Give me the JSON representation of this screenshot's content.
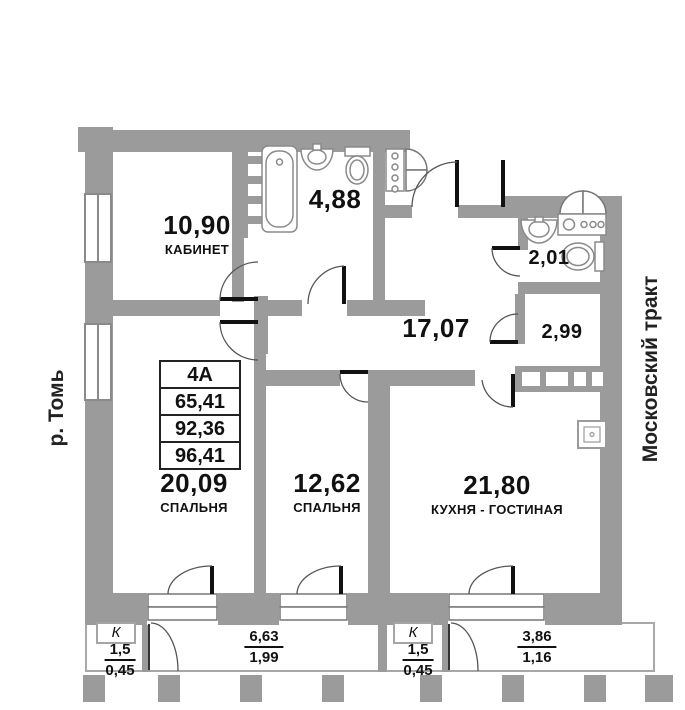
{
  "plan": {
    "title": "apartment-floor-plan",
    "streets": {
      "left": "р. Томь",
      "right": "Московский тракт"
    },
    "unit_table": {
      "unit": "4А",
      "rows": [
        "65,41",
        "92,36",
        "96,41"
      ]
    },
    "rooms": [
      {
        "id": "office",
        "area": "10,90",
        "name": "КАБИНЕТ"
      },
      {
        "id": "bathroom",
        "area": "4,88",
        "name": ""
      },
      {
        "id": "toilet",
        "area": "2,01",
        "name": ""
      },
      {
        "id": "hallway",
        "area": "17,07",
        "name": ""
      },
      {
        "id": "storage",
        "area": "2,99",
        "name": ""
      },
      {
        "id": "bedroom-1",
        "area": "20,09",
        "name": "СПАЛЬНЯ"
      },
      {
        "id": "bedroom-2",
        "area": "12,62",
        "name": "СПАЛЬНЯ"
      },
      {
        "id": "kitchen-living",
        "area": "21,80",
        "name": "КУХНЯ - ГОСТИНАЯ"
      }
    ],
    "balconies": [
      {
        "k_label": "К",
        "value_top": "1,5",
        "value_bottom": "0,45"
      },
      {
        "value_top": "6,63",
        "value_bottom": "1,99"
      },
      {
        "k_label": "К",
        "value_top": "1,5",
        "value_bottom": "0,45"
      },
      {
        "value_top": "3,86",
        "value_bottom": "1,16"
      }
    ],
    "icons": [
      "bathtub-icon",
      "sink-icon",
      "toilet-icon",
      "washing-machine-icon",
      "towel-rail-icon",
      "wardrobe-icon",
      "vent-shaft-icon",
      "electrical-panel-icon",
      "door-swing-icon",
      "window-icon"
    ],
    "colors": {
      "wall": "#9b9b9b",
      "text": "#111111",
      "line": "#555555"
    }
  }
}
